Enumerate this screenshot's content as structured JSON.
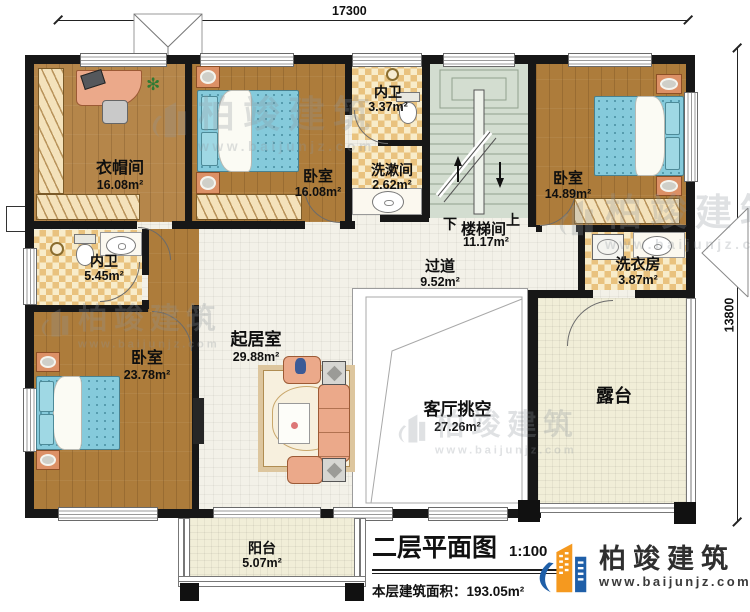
{
  "dimensions": {
    "top": "17300",
    "right": "13800"
  },
  "rooms": {
    "cloakroom": {
      "label": "衣帽间",
      "area": "16.08m²"
    },
    "bedroom_top": {
      "label": "卧室",
      "area": "16.08m²"
    },
    "bath_top": {
      "label": "内卫",
      "area": "3.37m²"
    },
    "washroom": {
      "label": "洗漱间",
      "area": "2.62m²"
    },
    "stairwell": {
      "label": "楼梯间",
      "area": "11.17m²",
      "down": "下",
      "up": "上"
    },
    "bedroom_right": {
      "label": "卧室",
      "area": "14.89m²"
    },
    "laundry": {
      "label": "洗衣房",
      "area": "3.87m²"
    },
    "bath_left": {
      "label": "内卫",
      "area": "5.45m²"
    },
    "corridor": {
      "label": "过道",
      "area": "9.52m²"
    },
    "living": {
      "label": "起居室",
      "area": "29.88m²"
    },
    "bedroom_bottom": {
      "label": "卧室",
      "area": "23.78m²"
    },
    "void": {
      "label": "客厅挑空",
      "area": "27.26m²"
    },
    "terrace": {
      "label": "露台"
    },
    "balcony": {
      "label": "阳台",
      "area": "5.07m²"
    }
  },
  "title_block": {
    "plan_title": "二层平面图",
    "scale": "1:100",
    "floor_area_label": "本层建筑面积：",
    "floor_area_value": "193.05m²",
    "floor_height_label": "层高：",
    "floor_height_value": "3.6m"
  },
  "branding": {
    "company": "柏竣建筑",
    "website": "www.baijunjz.com"
  },
  "watermark": {
    "company": "柏竣建筑",
    "website": "www.baijunjz.com"
  },
  "colors": {
    "wall": "#171717",
    "wood_floor": "#ad7c3b",
    "checker_tan": "#e9c27e",
    "tile": "#f3f1e8",
    "stair": "#d3ddd0",
    "terrace": "#f1eed8",
    "bed_blue": "#85cadb",
    "sofa_salmon": "#eba98a",
    "logo_blue": "#1f5fa8",
    "logo_orange": "#f5991f"
  }
}
